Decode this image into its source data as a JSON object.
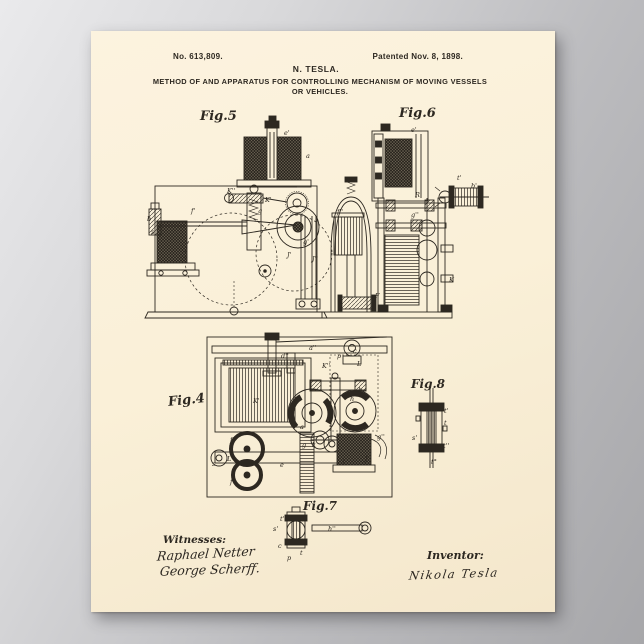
{
  "scene": {
    "backdrop_color_light": "#eaeaec",
    "backdrop_color_dark": "#a7a7aa",
    "paper_color": "#faf0d8",
    "ink_color": "#2d2821"
  },
  "header": {
    "patent_number": "No. 613,809.",
    "patented": "Patented Nov. 8, 1898.",
    "inventor_name": "N. TESLA.",
    "title_line1": "METHOD OF AND APPARATUS FOR CONTROLLING MECHANISM OF MOVING VESSELS",
    "title_line2": "OR VEHICLES."
  },
  "figures": {
    "fig5": {
      "label": "Fig.5"
    },
    "fig6": {
      "label": "Fig.6"
    },
    "fig4": {
      "label": "Fig.4"
    },
    "fig8": {
      "label": "Fig.8"
    },
    "fig7": {
      "label": "Fig.7"
    }
  },
  "ref_labels": [
    {
      "t": "e'",
      "x": 193,
      "y": 99
    },
    {
      "t": "a",
      "x": 215,
      "y": 122
    },
    {
      "t": "K''",
      "x": 136,
      "y": 157
    },
    {
      "t": "K'",
      "x": 174,
      "y": 166
    },
    {
      "t": "g",
      "x": 167,
      "y": 177
    },
    {
      "t": "b",
      "x": 56,
      "y": 185
    },
    {
      "t": "f'",
      "x": 100,
      "y": 177
    },
    {
      "t": "g'",
      "x": 212,
      "y": 208
    },
    {
      "t": "J'",
      "x": 196,
      "y": 221
    },
    {
      "t": "J''",
      "x": 221,
      "y": 225
    },
    {
      "t": "s",
      "x": 60,
      "y": 198
    },
    {
      "t": "e'",
      "x": 320,
      "y": 96
    },
    {
      "t": "d",
      "x": 296,
      "y": 132
    },
    {
      "t": "R",
      "x": 324,
      "y": 161
    },
    {
      "t": "g''",
      "x": 320,
      "y": 181
    },
    {
      "t": "t'",
      "x": 366,
      "y": 144
    },
    {
      "t": "b'",
      "x": 380,
      "y": 152
    },
    {
      "t": "K",
      "x": 358,
      "y": 246
    },
    {
      "t": "F",
      "x": 284,
      "y": 262
    },
    {
      "t": "f''",
      "x": 246,
      "y": 178
    },
    {
      "t": "d''",
      "x": 190,
      "y": 322
    },
    {
      "t": "a''",
      "x": 218,
      "y": 314
    },
    {
      "t": "c",
      "x": 262,
      "y": 317
    },
    {
      "t": "p",
      "x": 246,
      "y": 322
    },
    {
      "t": "K''",
      "x": 231,
      "y": 332
    },
    {
      "t": "L",
      "x": 266,
      "y": 330
    },
    {
      "t": "K'",
      "x": 162,
      "y": 367
    },
    {
      "t": "h",
      "x": 259,
      "y": 365
    },
    {
      "t": "b",
      "x": 267,
      "y": 356
    },
    {
      "t": "a",
      "x": 209,
      "y": 393
    },
    {
      "t": "g",
      "x": 211,
      "y": 411
    },
    {
      "t": "k",
      "x": 221,
      "y": 411
    },
    {
      "t": "f",
      "x": 139,
      "y": 406
    },
    {
      "t": "L'",
      "x": 136,
      "y": 425
    },
    {
      "t": "s",
      "x": 121,
      "y": 430
    },
    {
      "t": "f'",
      "x": 139,
      "y": 448
    },
    {
      "t": "e",
      "x": 189,
      "y": 431
    },
    {
      "t": "g''",
      "x": 286,
      "y": 403
    },
    {
      "t": "J",
      "x": 251,
      "y": 428
    },
    {
      "t": "J'",
      "x": 274,
      "y": 425
    },
    {
      "t": "t'",
      "x": 353,
      "y": 377
    },
    {
      "t": "t",
      "x": 353,
      "y": 389
    },
    {
      "t": "s'",
      "x": 321,
      "y": 404
    },
    {
      "t": "t''",
      "x": 352,
      "y": 412
    },
    {
      "t": "t°",
      "x": 340,
      "y": 428
    },
    {
      "t": "t'",
      "x": 189,
      "y": 485
    },
    {
      "t": "s'",
      "x": 182,
      "y": 495
    },
    {
      "t": "h''",
      "x": 237,
      "y": 495
    },
    {
      "t": "c",
      "x": 187,
      "y": 512
    },
    {
      "t": "t",
      "x": 209,
      "y": 519
    },
    {
      "t": "p",
      "x": 196,
      "y": 524
    }
  ],
  "footer": {
    "witnesses_label": "Witnesses:",
    "witness1_signature": "Raphael Netter",
    "witness2_signature": "George Scherff.",
    "inventor_label": "Inventor:",
    "inventor_signature": "Nikola Tesla"
  }
}
